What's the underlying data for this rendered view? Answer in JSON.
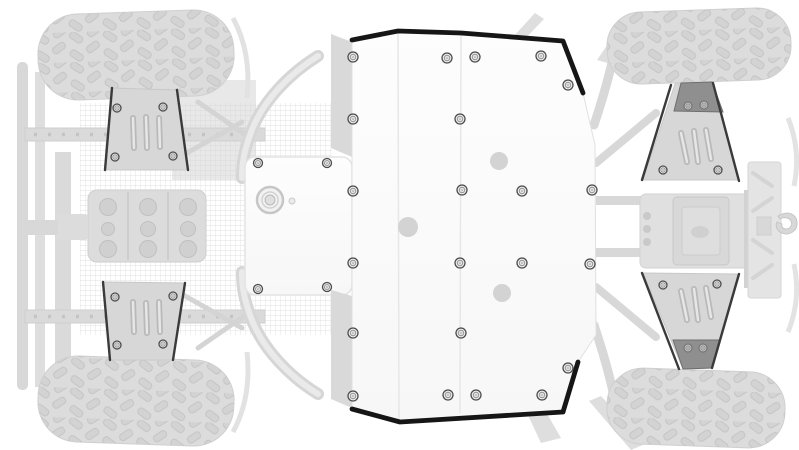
{
  "illustration": {
    "palette": {
      "background": "#ffffff",
      "plate_fill_top": "#fdfdfd",
      "plate_fill_bottom": "#f6f6f6",
      "plate_edge": "#161616",
      "plate_seam": "#e7e7e7",
      "plate_outline": "#e0e0e0",
      "flange_fill": "#d9d9d9",
      "bolt_ring": "#4c4c4c",
      "bolt_fill": "#eeeeee",
      "hole_fill": "#d3d3d3",
      "guard_fill": "#d7d7d7",
      "guard_dark": "#8f8f8f",
      "guard_edge": "#3a3a3a",
      "tire_fill": "#dcdcdc",
      "tire_outline": "#cfcfcf"
    },
    "main_plate": {
      "outline": [
        [
          352,
          40
        ],
        [
          398,
          31
        ],
        [
          461,
          33
        ],
        [
          563,
          41
        ],
        [
          583,
          93
        ],
        [
          595,
          145
        ],
        [
          596,
          335
        ],
        [
          578,
          362
        ],
        [
          563,
          412
        ],
        [
          400,
          422
        ],
        [
          352,
          410
        ]
      ],
      "flanges": [
        [
          [
            331,
            34
          ],
          [
            352,
            42
          ],
          [
            352,
            157
          ],
          [
            331,
            148
          ]
        ],
        [
          [
            331,
            290
          ],
          [
            352,
            296
          ],
          [
            352,
            408
          ],
          [
            331,
            399
          ]
        ]
      ],
      "edge_top": [
        [
          352,
          40
        ],
        [
          398,
          31
        ],
        [
          461,
          33
        ],
        [
          563,
          41
        ],
        [
          583,
          93
        ]
      ],
      "edge_bottom": [
        [
          352,
          409
        ],
        [
          400,
          422
        ],
        [
          563,
          412
        ],
        [
          578,
          362
        ]
      ],
      "seams": [
        [
          [
            398,
            33
          ],
          [
            399,
            421
          ]
        ],
        [
          [
            461,
            34
          ],
          [
            460,
            413
          ]
        ]
      ],
      "holes": [
        [
          499,
          161,
          9
        ],
        [
          408,
          227,
          10
        ],
        [
          502,
          293,
          9
        ]
      ],
      "bolts": [
        [
          353,
          57
        ],
        [
          447,
          58
        ],
        [
          475,
          57
        ],
        [
          541,
          56
        ],
        [
          568,
          85
        ],
        [
          353,
          119
        ],
        [
          460,
          119
        ],
        [
          353,
          191
        ],
        [
          462,
          190
        ],
        [
          522,
          191
        ],
        [
          592,
          190
        ],
        [
          353,
          263
        ],
        [
          460,
          263
        ],
        [
          522,
          263
        ],
        [
          590,
          264
        ],
        [
          353,
          333
        ],
        [
          461,
          333
        ],
        [
          568,
          368
        ],
        [
          353,
          396
        ],
        [
          448,
          395
        ],
        [
          476,
          395
        ],
        [
          542,
          395
        ]
      ]
    },
    "front_diff_plate": {
      "rect": [
        245,
        157,
        107,
        138
      ],
      "corner_radius": 10,
      "bolts": [
        [
          258,
          163
        ],
        [
          327,
          163
        ],
        [
          258,
          289
        ],
        [
          327,
          287
        ]
      ],
      "plug": {
        "cx": 270,
        "cy": 200,
        "r": 13
      },
      "plug_dot": {
        "cx": 292,
        "cy": 201,
        "r": 3
      }
    },
    "arm_guards": [
      {
        "id": "front-upper",
        "body": [
          [
            112,
            88
          ],
          [
            177,
            90
          ],
          [
            188,
            170
          ],
          [
            105,
            170
          ]
        ],
        "edges": [
          [
            [
              112,
              88
            ],
            [
              105,
              170
            ]
          ],
          [
            [
              177,
              90
            ],
            [
              188,
              170
            ]
          ]
        ],
        "slots": [
          [
            [
              133,
              118
            ],
            [
              134,
              148
            ]
          ],
          [
            [
              146,
              117
            ],
            [
              147,
              148
            ]
          ],
          [
            [
              159,
              118
            ],
            [
              160,
              147
            ]
          ]
        ],
        "bolts": [
          [
            117,
            108
          ],
          [
            163,
            107
          ],
          [
            115,
            157
          ],
          [
            173,
            156
          ]
        ]
      },
      {
        "id": "front-lower",
        "body": [
          [
            103,
            282
          ],
          [
            185,
            283
          ],
          [
            173,
            360
          ],
          [
            110,
            360
          ]
        ],
        "edges": [
          [
            [
              103,
              282
            ],
            [
              110,
              360
            ]
          ],
          [
            [
              185,
              283
            ],
            [
              173,
              360
            ]
          ]
        ],
        "slots": [
          [
            [
              133,
              302
            ],
            [
              134,
              332
            ]
          ],
          [
            [
              146,
              303
            ],
            [
              147,
              333
            ]
          ],
          [
            [
              159,
              302
            ],
            [
              160,
              332
            ]
          ]
        ],
        "bolts": [
          [
            115,
            297
          ],
          [
            173,
            296
          ],
          [
            117,
            345
          ],
          [
            163,
            344
          ]
        ]
      },
      {
        "id": "rear-upper",
        "body": [
          [
            675,
            84
          ],
          [
            712,
            82
          ],
          [
            738,
            180
          ],
          [
            643,
            180
          ]
        ],
        "dark": [
          [
            681,
            83
          ],
          [
            712,
            82
          ],
          [
            723,
            112
          ],
          [
            674,
            111
          ]
        ],
        "edges": [
          [
            [
              671,
              85
            ],
            [
              642,
              180
            ]
          ],
          [
            [
              713,
              83
            ],
            [
              739,
              181
            ]
          ]
        ],
        "slots": [
          [
            [
              681,
              133
            ],
            [
              687,
              162
            ]
          ],
          [
            [
              694,
              131
            ],
            [
              698,
              162
            ]
          ],
          [
            [
              706,
              130
            ],
            [
              711,
              159
            ]
          ]
        ],
        "bolts": [
          [
            663,
            170
          ],
          [
            718,
            170
          ]
        ],
        "dark_bolts": [
          [
            688,
            106
          ],
          [
            704,
            105
          ]
        ]
      },
      {
        "id": "rear-lower",
        "body": [
          [
            643,
            273
          ],
          [
            738,
            274
          ],
          [
            712,
            368
          ],
          [
            683,
            369
          ]
        ],
        "dark": [
          [
            673,
            340
          ],
          [
            720,
            340
          ],
          [
            712,
            368
          ],
          [
            683,
            369
          ]
        ],
        "edges": [
          [
            [
              642,
              273
            ],
            [
              679,
              369
            ]
          ],
          [
            [
              739,
              274
            ],
            [
              712,
              368
            ]
          ]
        ],
        "slots": [
          [
            [
              681,
              291
            ],
            [
              687,
              320
            ]
          ],
          [
            [
              694,
              289
            ],
            [
              698,
              320
            ]
          ],
          [
            [
              706,
              288
            ],
            [
              711,
              317
            ]
          ]
        ],
        "bolts": [
          [
            663,
            285
          ],
          [
            717,
            284
          ]
        ],
        "dark_bolts": [
          [
            688,
            348
          ],
          [
            703,
            348
          ]
        ]
      }
    ],
    "tires": [
      {
        "id": "front-upper-tire",
        "x": 38,
        "y": 12,
        "w": 196,
        "h": 86,
        "r": 40,
        "angle": -2
      },
      {
        "id": "front-lower-tire",
        "x": 38,
        "y": 358,
        "w": 196,
        "h": 86,
        "r": 40,
        "angle": 2
      },
      {
        "id": "rear-upper-tire",
        "x": 607,
        "y": 10,
        "w": 184,
        "h": 72,
        "r": 34,
        "angle": -2
      },
      {
        "id": "rear-lower-tire",
        "x": 607,
        "y": 370,
        "w": 178,
        "h": 76,
        "r": 36,
        "angle": 2
      }
    ]
  }
}
